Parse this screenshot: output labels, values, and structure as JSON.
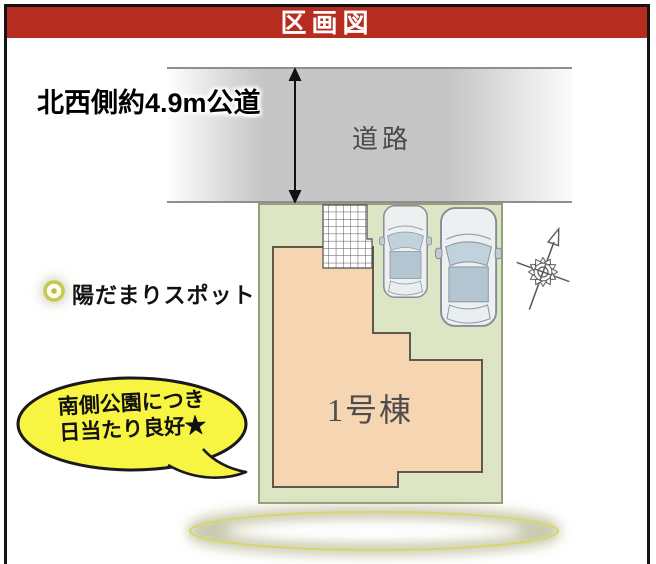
{
  "banner": {
    "title": "区画図"
  },
  "road": {
    "label": "道路",
    "dimension_label": "北西側約4.9m公道"
  },
  "site": {
    "building_label": "1号棟"
  },
  "legend": {
    "sun_spot_label": "陽だまりスポット"
  },
  "callout": {
    "line1": "南側公園につき",
    "line2": "日当たり良好★"
  },
  "icons": {
    "compass": "compass-north-arrow",
    "sun_spot": "sun-spot-marker",
    "road_width_arrow": "double-headed-arrow"
  },
  "colors": {
    "banner_red": "#b62d20",
    "road_gray": "#c6c6c6",
    "plot_green": "#dce6c5",
    "building_peach": "#f6d5b3",
    "callout_yellow": "#f7f542",
    "highlight_ring_yellow": "#d5d868"
  }
}
